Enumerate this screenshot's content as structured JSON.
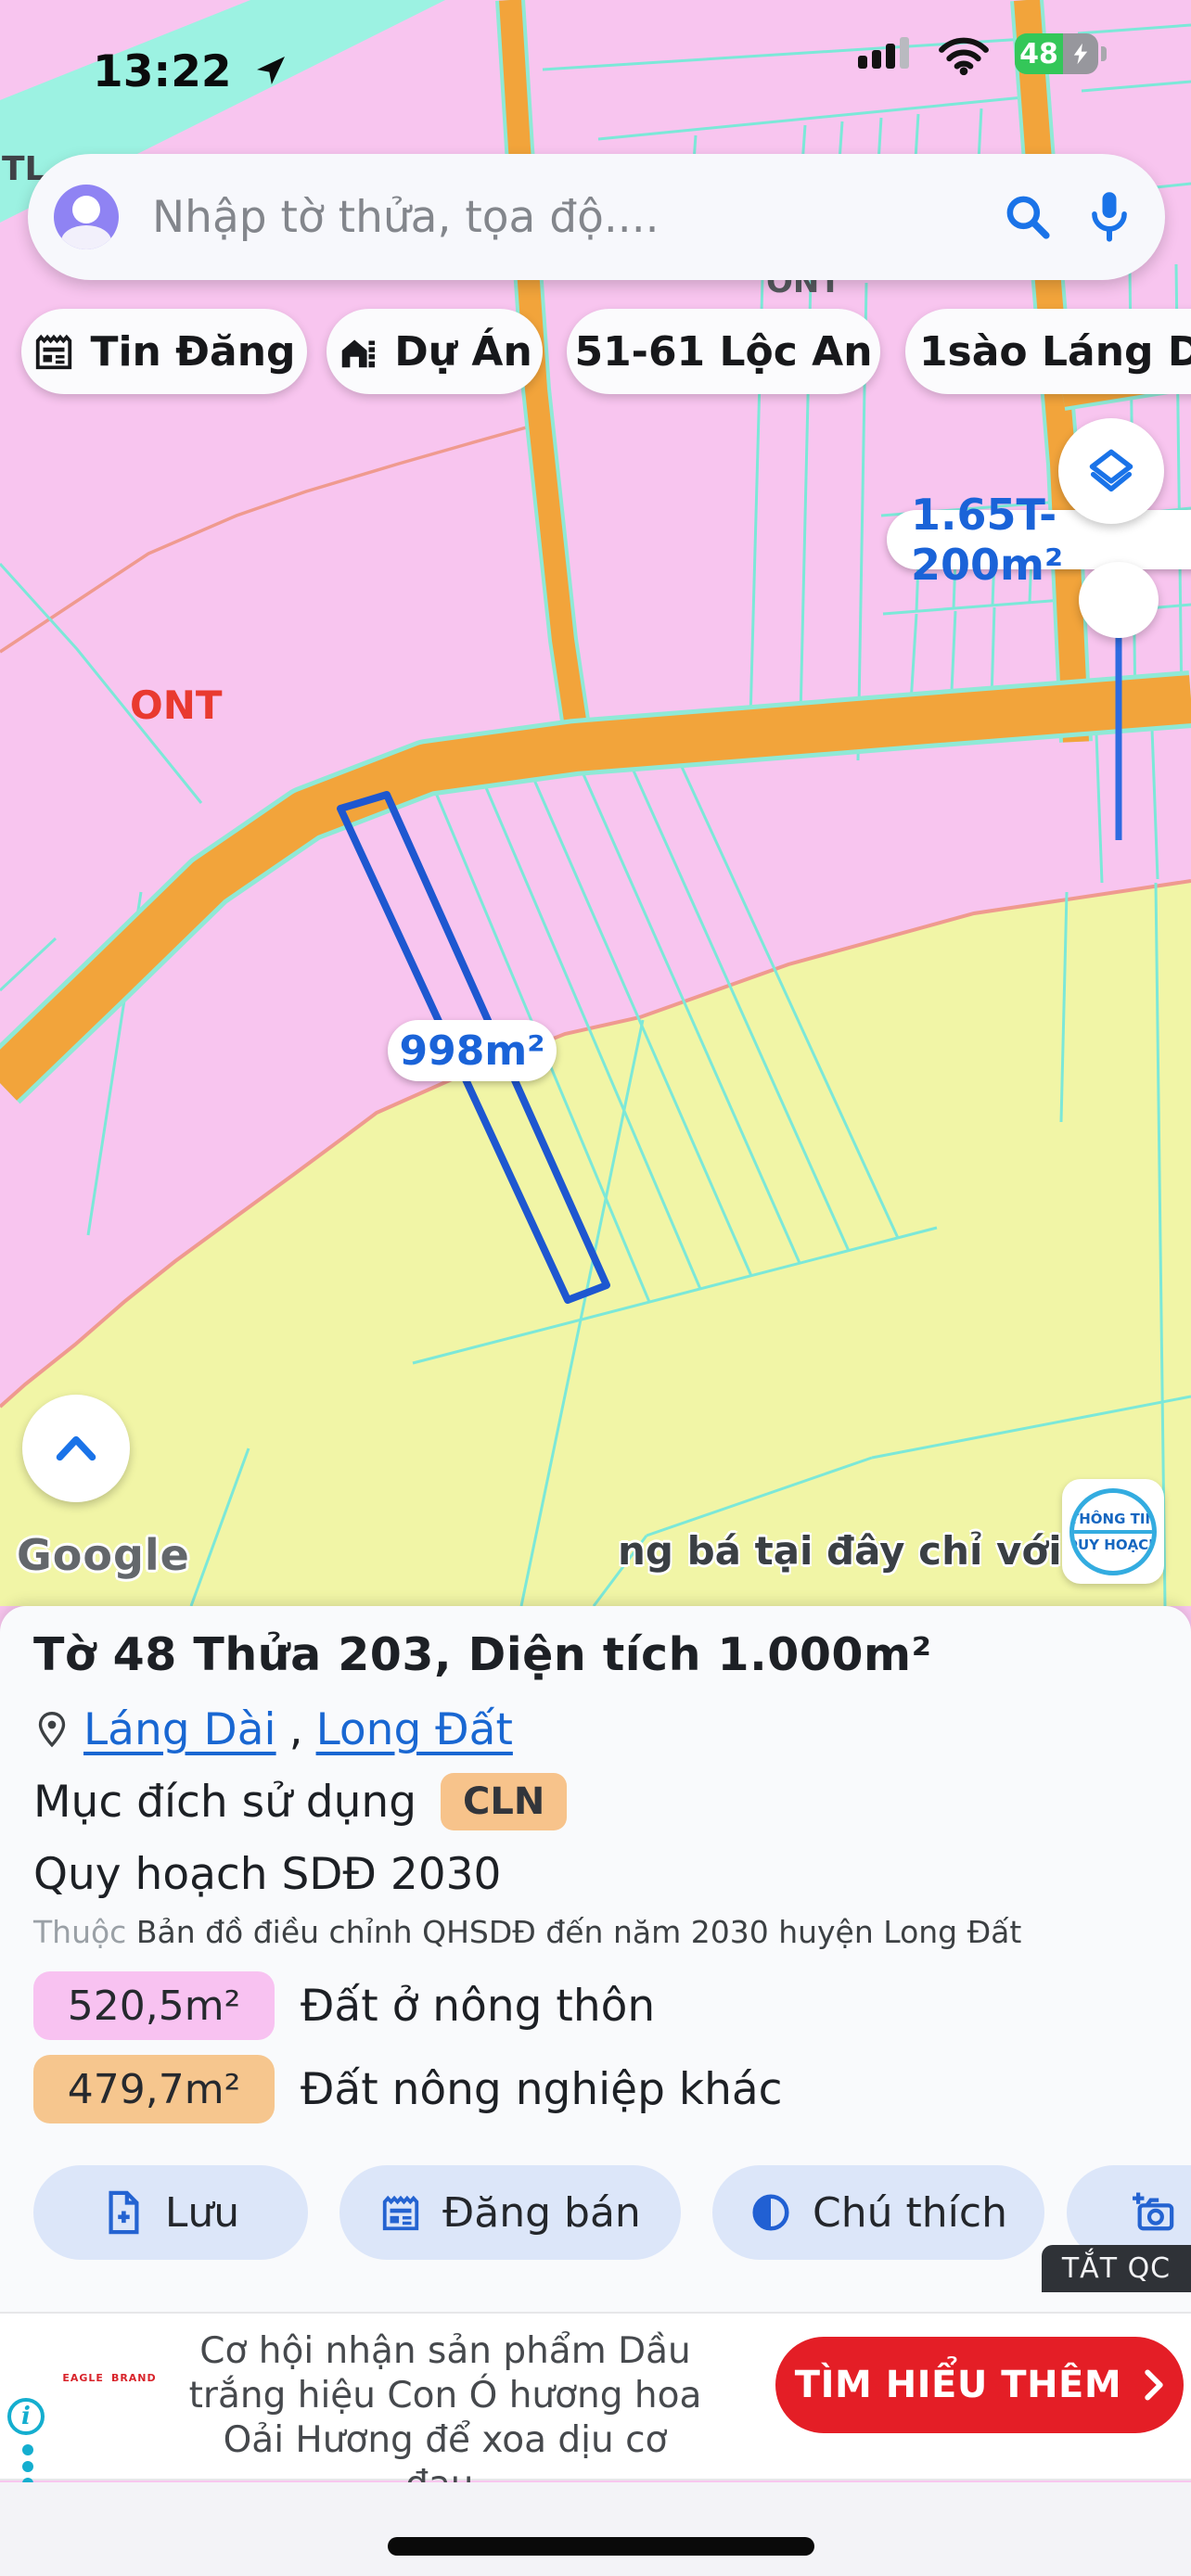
{
  "status_bar": {
    "time": "13:22",
    "battery_percent": "48"
  },
  "search": {
    "placeholder": "Nhập tờ thửa, tọa độ...."
  },
  "chips": [
    {
      "label": "Tin Đăng"
    },
    {
      "label": "Dự Án"
    },
    {
      "label": "51-61 Lộc An"
    },
    {
      "label": "1sào Láng Dà"
    }
  ],
  "map": {
    "labels": {
      "tl": "TL",
      "ont_red": "ONT",
      "ont_gray": "ONT",
      "selected_parcel_area": "998m²",
      "listing_tag": "1.65T-200m²",
      "ad_marquee": "ng bá tại đây chỉ với 19k",
      "google_watermark": "Google",
      "qh_badge_line1": "THÔNG TIN",
      "qh_badge_line2": "QUY HOẠCH"
    },
    "colors": {
      "pink_zone": "#F8C5EF",
      "yellow_zone": "#F1F5A6",
      "road_orange": "#F2A43B",
      "parcel_line_cyan": "#7CE8D8",
      "boundary_salmon": "#EF9A8F",
      "selected_parcel_blue": "#1E57D0"
    }
  },
  "panel": {
    "title": "Tờ 48 Thửa 203, Diện tích 1.000m²",
    "location_link1": "Láng Dài",
    "location_separator": ",",
    "location_link2": "Long Đất",
    "purpose_label": "Mục đích sử dụng",
    "purpose_badge": "CLN",
    "plan_title": "Quy hoạch SDĐ 2030",
    "plan_source_prefix": "Thuộc",
    "plan_source": "Bản đồ điều chỉnh QHSDĐ đến năm 2030 huyện Long Đất",
    "zones": [
      {
        "area": "520,5m²",
        "label": "Đất ở nông thôn"
      },
      {
        "area": "479,7m²",
        "label": "Đất nông nghiệp khác"
      }
    ],
    "actions": [
      {
        "label": "Lưu"
      },
      {
        "label": "Đăng bán"
      },
      {
        "label": "Chú thích"
      },
      {
        "label": "C"
      }
    ],
    "dismiss_ad_label": "TẮT QC"
  },
  "ad": {
    "brand_left": "EAGLE",
    "brand_right": "BRAND",
    "text": "Cơ hội nhận sản phẩm Dầu trắng hiệu Con Ó hương hoa Oải Hương để xoa dịu cơ đau.",
    "cta": "TÌM HIỂU THÊM"
  }
}
